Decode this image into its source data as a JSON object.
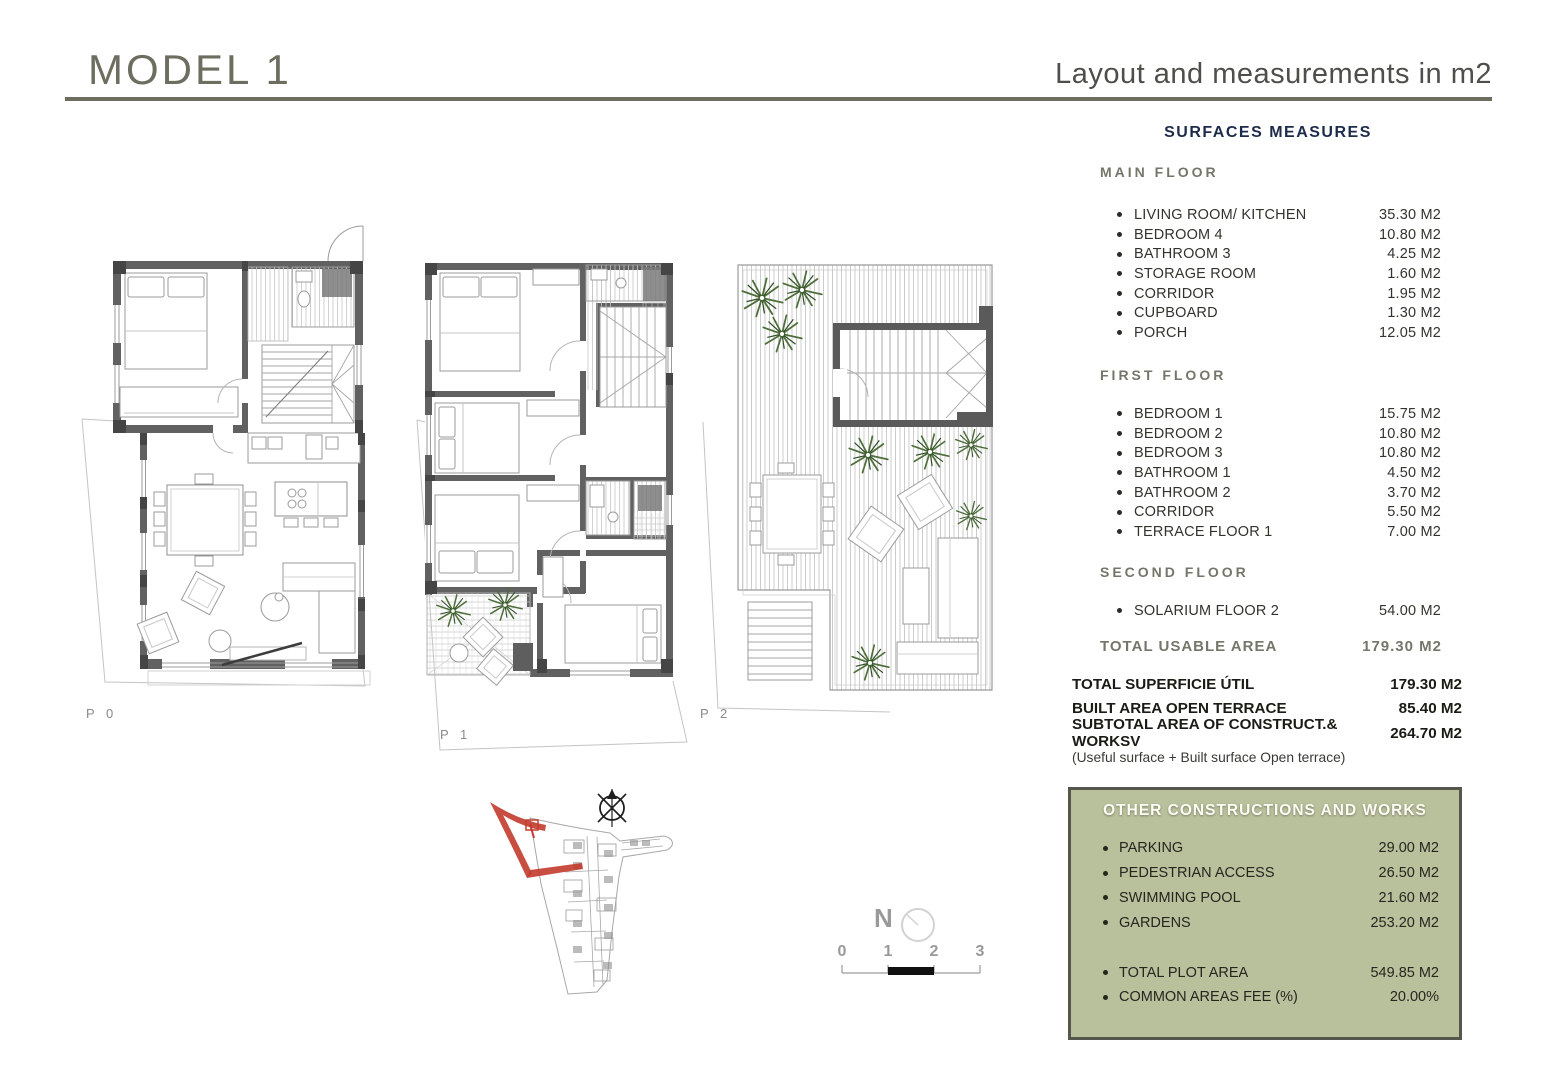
{
  "header": {
    "title": "MODEL 1",
    "subtitle": "Layout and measurements in m2"
  },
  "surfaces": {
    "heading": "SURFACES MEASURES",
    "sections": [
      {
        "label": "MAIN FLOOR",
        "items": [
          {
            "label": "LIVING ROOM/ KITCHEN",
            "value": "35.30 M2"
          },
          {
            "label": "BEDROOM 4",
            "value": "10.80 M2"
          },
          {
            "label": "BATHROOM 3",
            "value": "4.25 M2"
          },
          {
            "label": "STORAGE ROOM",
            "value": "1.60 M2"
          },
          {
            "label": "CORRIDOR",
            "value": "1.95 M2"
          },
          {
            "label": "CUPBOARD",
            "value": "1.30 M2"
          },
          {
            "label": "PORCH",
            "value": "12.05 M2"
          }
        ]
      },
      {
        "label": "FIRST FLOOR",
        "items": [
          {
            "label": "BEDROOM 1",
            "value": "15.75 M2"
          },
          {
            "label": "BEDROOM 2",
            "value": "10.80 M2"
          },
          {
            "label": "BEDROOM 3",
            "value": "10.80 M2"
          },
          {
            "label": "BATHROOM 1",
            "value": "4.50 M2"
          },
          {
            "label": "BATHROOM 2",
            "value": "3.70 M2"
          },
          {
            "label": "CORRIDOR",
            "value": "5.50 M2"
          },
          {
            "label": "TERRACE FLOOR 1",
            "value": "7.00 M2"
          }
        ]
      },
      {
        "label": "SECOND FLOOR",
        "items": [
          {
            "label": "SOLARIUM FLOOR 2",
            "value": "54.00 M2"
          }
        ]
      }
    ],
    "total_usable": {
      "label": "TOTAL USABLE AREA",
      "value": "179.30 M2"
    },
    "totals": [
      {
        "label": "TOTAL SUPERFICIE ÚTIL",
        "value": "179.30 M2"
      },
      {
        "label": "BUILT AREA OPEN TERRACE",
        "value": "85.40 M2"
      },
      {
        "label": "SUBTOTAL AREA OF CONSTRUCT.& WORKSV",
        "value": "264.70 M2"
      }
    ],
    "totals_note": "(Useful surface + Built surface Open terrace)"
  },
  "other_constructions": {
    "heading": "OTHER CONSTRUCTIONS AND WORKS",
    "items": [
      {
        "label": "PARKING",
        "value": "29.00 M2"
      },
      {
        "label": "PEDESTRIAN ACCESS",
        "value": "26.50 M2"
      },
      {
        "label": "SWIMMING POOL",
        "value": "21.60 M2"
      },
      {
        "label": "GARDENS",
        "value": "253.20 M2"
      }
    ],
    "totals": [
      {
        "label": "TOTAL PLOT AREA",
        "value": "549.85 M2"
      },
      {
        "label": "COMMON AREAS FEE (%)",
        "value": "20.00%"
      }
    ]
  },
  "plans": {
    "p0": "P 0",
    "p1": "P 1",
    "p2": "P 2"
  },
  "site": {
    "north_label": "N"
  },
  "scale_bar": {
    "ticks": [
      "0",
      "1",
      "2",
      "3"
    ]
  },
  "colors": {
    "accent_olive": "#6d6e60",
    "heading_navy": "#1c2b4a",
    "box_green": "#b9c09c",
    "box_border": "#56564c",
    "plot_red": "#c23b2e",
    "wall_gray": "#616161",
    "plan_line": "#9b9b9b",
    "plant_green": "#4e6f3a"
  }
}
